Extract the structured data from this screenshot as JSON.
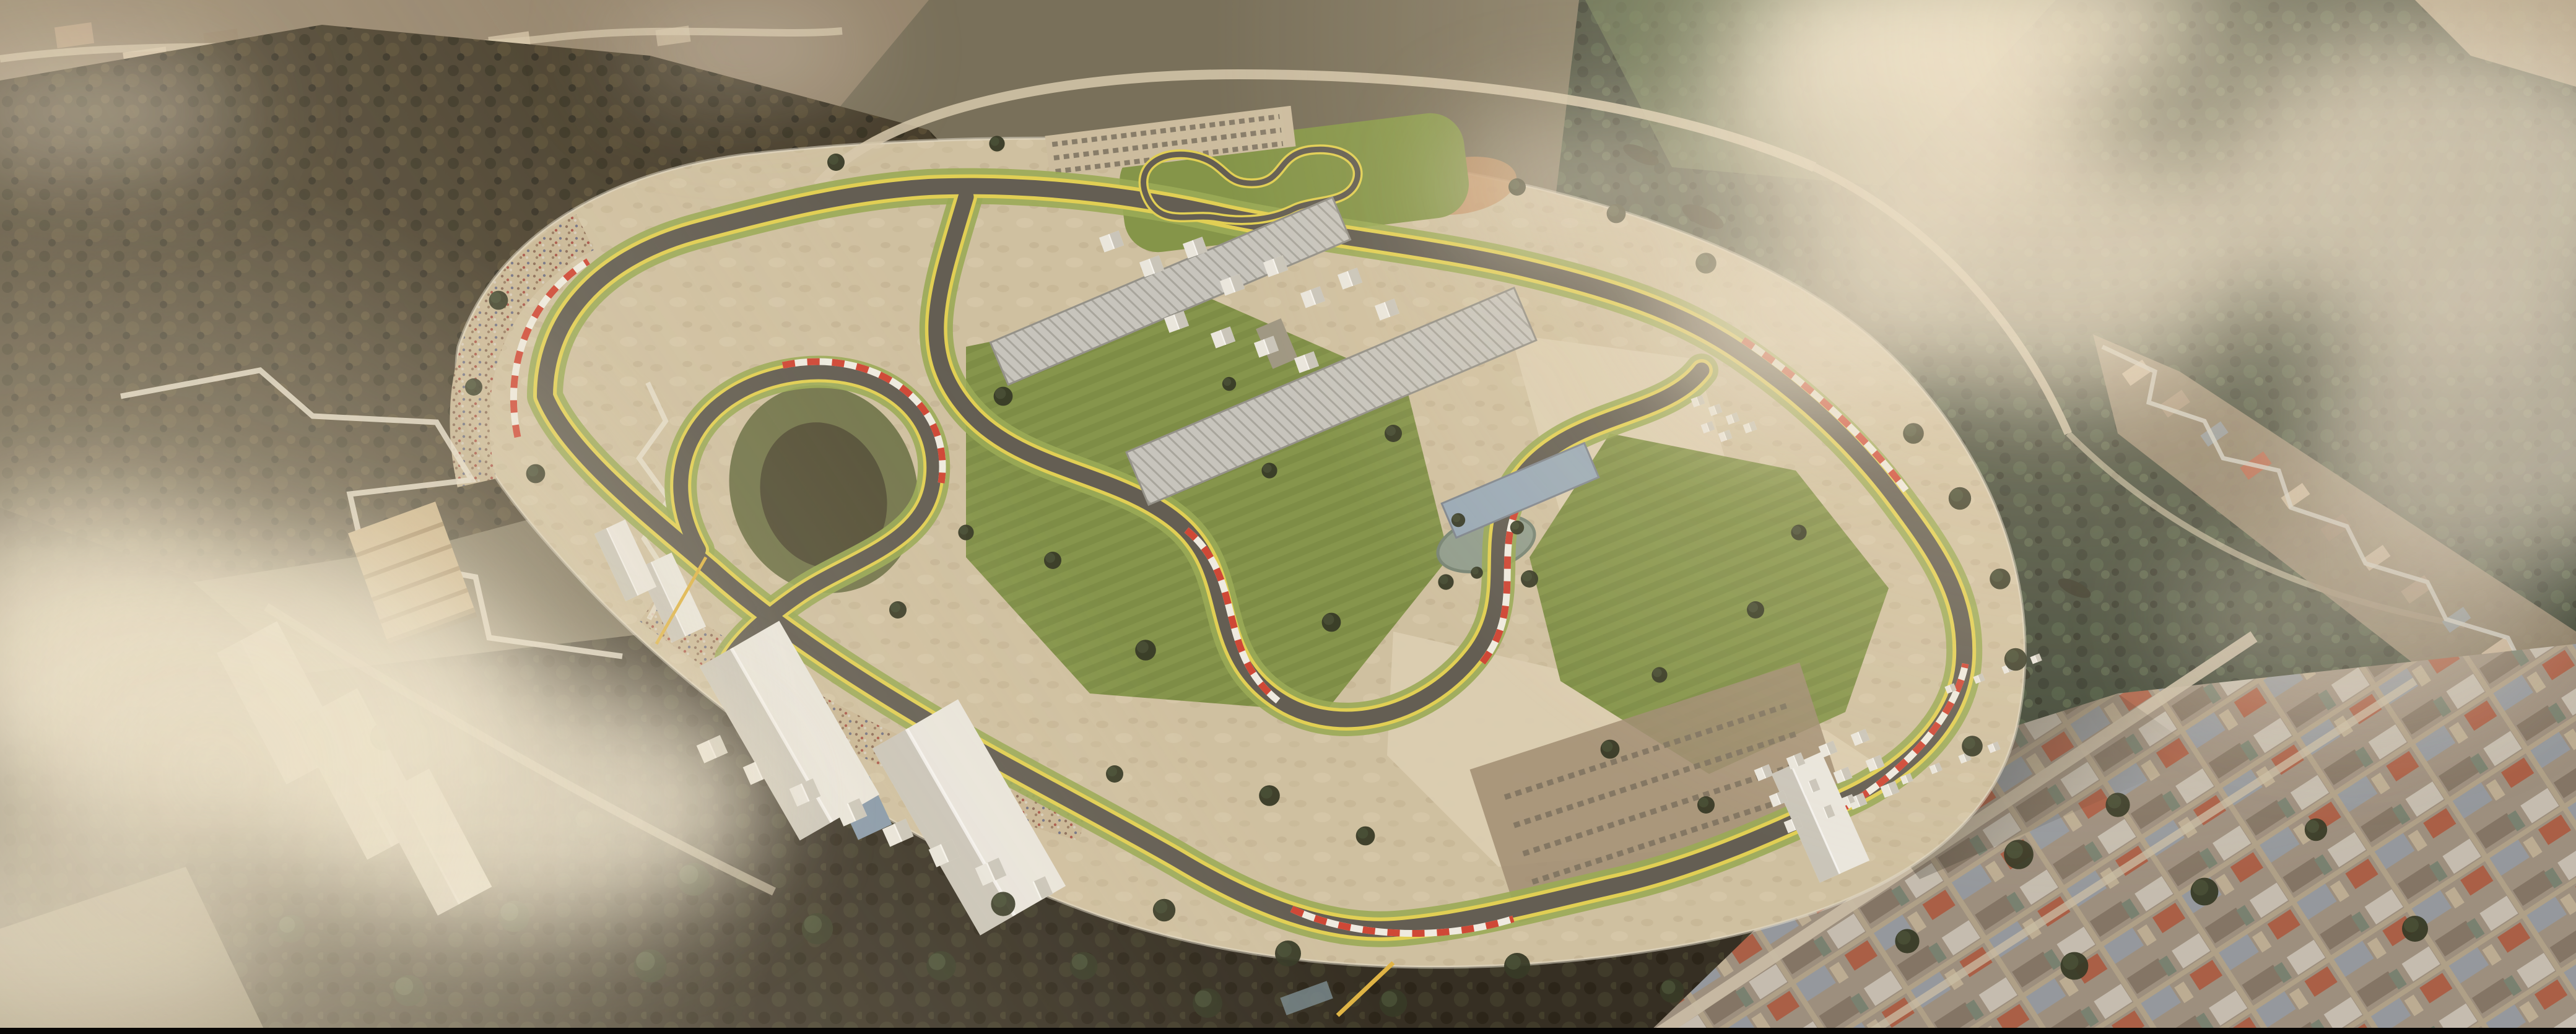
{
  "meta": {
    "description": "Sunset aerial 3D rendering of a motorsport circuit complex set in a mountain valley: a looping race track with yellow edge lines and red-white kerbs, infield esses, a karting track on a green platform, pit and paddock buildings, white event tents, a tiered grandstand, sand runoff areas, ponds, spectator banks, surrounded by dark forested hills, hillside villages, a dense town grid at lower right, and drifting hazy clouds."
  },
  "palette": {
    "base_ground": "#6f6752",
    "forest_dark": "#372f1f",
    "forest_deep": "#241f12",
    "forest_green": "#2a3527",
    "forest_black": "#241f15",
    "hill_light": "#5d7047",
    "valley_light": "#8f7f68",
    "sand": "#cfc0a0",
    "sand_light": "#dccfb2",
    "grass": "#7d9042",
    "grass_light": "#93a74e",
    "track_asphalt": "#57534a",
    "track_yellow": "#e3d14b",
    "kerb_red": "#cf3a2a",
    "kerb_white": "#f2efe6",
    "roof_gray": "#c6c5bf",
    "roof_stripe": "#a3a29b",
    "roof_blue": "#93a7b8",
    "tent_white": "#eceae3",
    "tent_shadow": "#c9c6bc",
    "grandstand_tan": "#c6ab7d",
    "grandstand_stripe": "#97794e",
    "town_base": "#97897a",
    "road_light": "#d7c9ad",
    "road_white": "#e9e2d2",
    "water_green": "#8b9a8b",
    "water_blue": "#7d93aa",
    "cloud": "#efe6d2",
    "cloud_warm": "#e2d8c4",
    "haze": "#f0e4c8",
    "sun_glow": "#ffeccd",
    "crane_yellow": "#e0b23a",
    "dirt_orange": "#c08a5a",
    "letterbox": "#070604"
  },
  "scene": {
    "landscape_features": [
      "forested-hill-northwest",
      "forested-hill-east",
      "valley-village-north",
      "hillside-village-east",
      "town-grid-southeast",
      "forest-band-south",
      "low-clouds",
      "sunset-haze",
      "sun-glow"
    ],
    "circuit_features": [
      "main-track-loop",
      "infield-esses",
      "teardrop-hairpin",
      "kart-track",
      "pit-buildings",
      "paddock-tents",
      "tiered-grandstand",
      "warehouse-tents",
      "spectator-banks",
      "parking-areas",
      "infield-ponds",
      "sand-runoff",
      "grass-verges",
      "red-white-kerbs",
      "service-roads",
      "construction-crane"
    ]
  }
}
